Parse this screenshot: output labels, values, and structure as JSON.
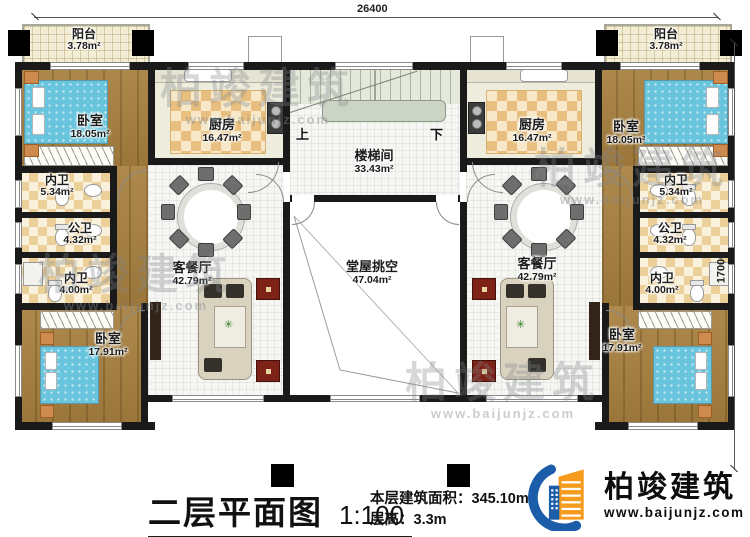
{
  "meta": {
    "title": "二层平面图",
    "scale": "1:100"
  },
  "dimensions": {
    "top": "26400",
    "right": "17000"
  },
  "stats": {
    "area_label": "本层建筑面积：",
    "area_value": "345.10m²",
    "floor_height_label": "层高：",
    "floor_height_value": "3.3m"
  },
  "stairs": {
    "up": "上",
    "down": "下"
  },
  "rooms": {
    "balcony": {
      "name": "阳台",
      "area": "3.78m²"
    },
    "bedroom_front": {
      "name": "卧室",
      "area": "18.05m²"
    },
    "kitchen": {
      "name": "厨房",
      "area": "16.47m²"
    },
    "ensuite_front": {
      "name": "内卫",
      "area": "5.34m²"
    },
    "shared_bath": {
      "name": "公卫",
      "area": "4.32m²"
    },
    "ensuite_rear": {
      "name": "内卫",
      "area": "4.00m²"
    },
    "bedroom_rear": {
      "name": "卧室",
      "area": "17.91m²"
    },
    "living_dining": {
      "name": "客餐厅",
      "area": "42.79m²"
    },
    "stair_hall": {
      "name": "楼梯间",
      "area": "33.43m²"
    },
    "hall_void": {
      "name": "堂屋挑空",
      "area": "47.04m²"
    }
  },
  "logo": {
    "company": "柏竣建筑",
    "website": "www.baijunjz.com"
  },
  "watermark": {
    "company": "柏竣建筑",
    "website": "www.baijunjz.com"
  },
  "colors": {
    "accent_blue": "#1b5da9",
    "accent_orange": "#f59c1e",
    "wall": "#1a1a1a"
  }
}
